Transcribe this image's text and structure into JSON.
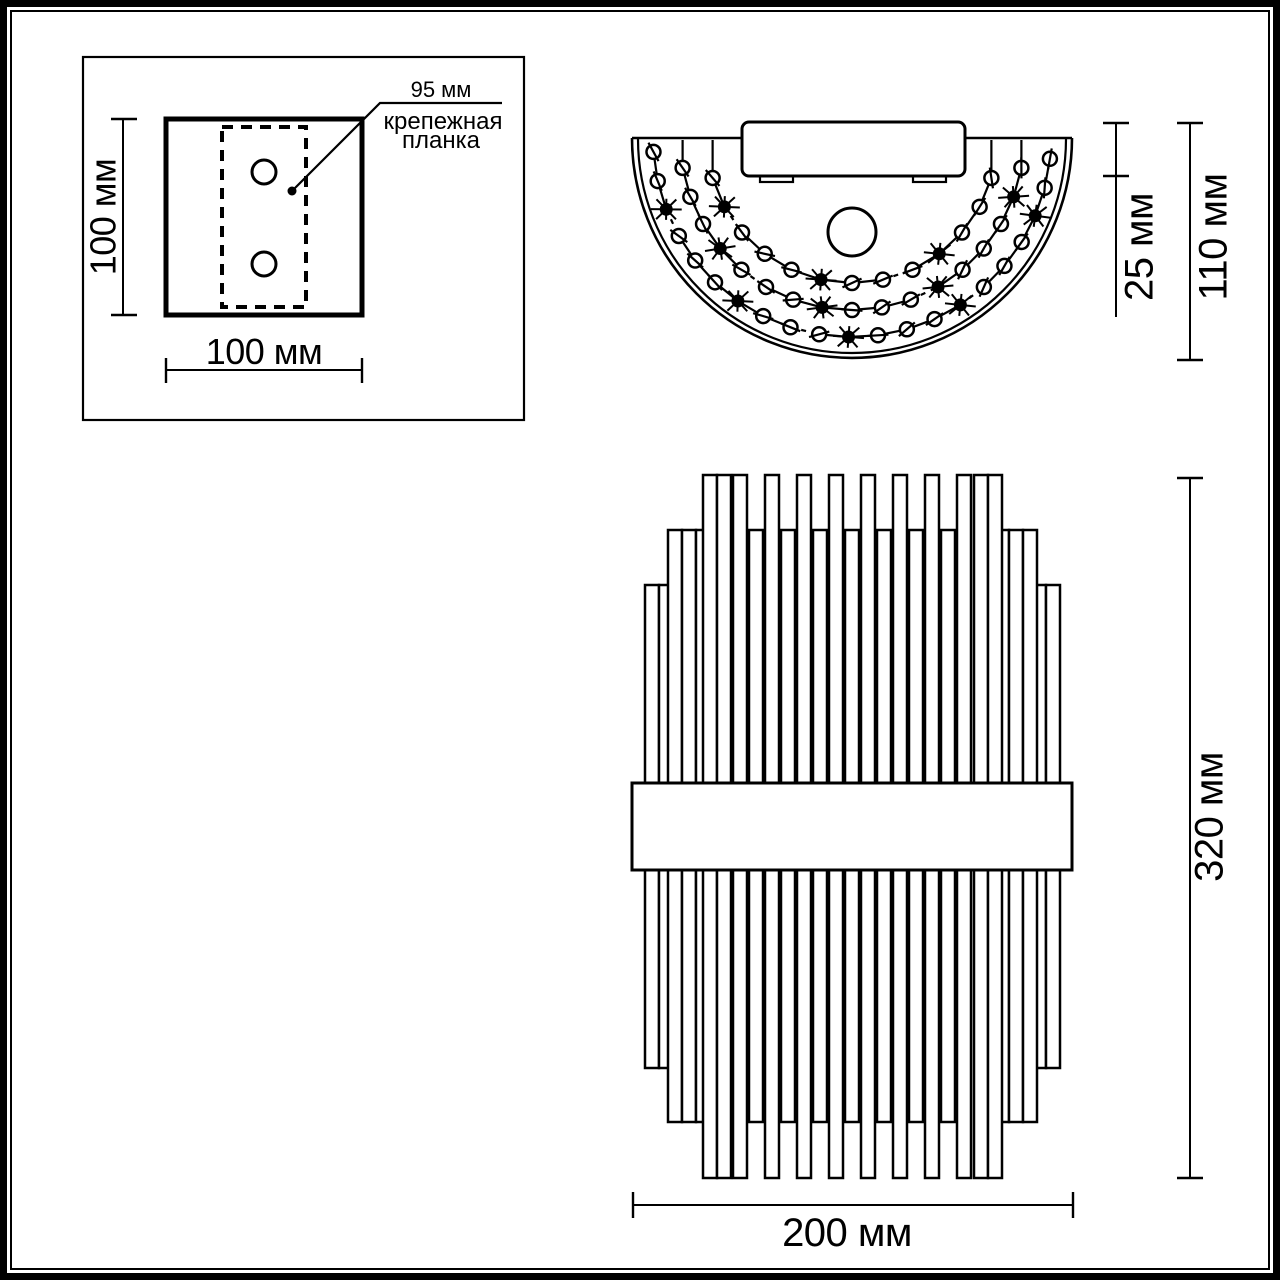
{
  "labels": {
    "plate_height": "100 мм",
    "plate_width": "100 мм",
    "plate_bar_length": "95 мм",
    "plate_note_line1": "крепежная",
    "plate_note_line2": "планка",
    "mount_depth": "25 мм",
    "total_depth": "110 мм",
    "total_height": "320 мм",
    "total_width": "200 мм"
  },
  "colors": {
    "ink": "#000000",
    "paper": "#ffffff"
  },
  "top_view": {
    "center": [
      852,
      138
    ],
    "strands": [
      {
        "r": 199,
        "n": 21,
        "a0": 176,
        "a1": 6,
        "black_every": 4,
        "black_offset": 2,
        "dash_every": 6,
        "dash_offset": 2,
        "connect": false
      },
      {
        "r": 172,
        "n": 17,
        "a0": 170,
        "a1": 10,
        "black_every": 4,
        "black_offset": 1,
        "dash_every": 6,
        "dash_offset": 4,
        "connect": true
      },
      {
        "r": 145,
        "n": 13,
        "a0": 164,
        "a1": 16,
        "black_every": 4,
        "black_offset": 3,
        "dash_every": 6,
        "dash_offset": 1,
        "connect": true
      }
    ]
  },
  "front_view": {
    "rod_width": 14,
    "tiers": {
      "A": {
        "top": 475,
        "bottom": 1178
      },
      "B": {
        "top": 530,
        "bottom": 1122
      },
      "C": {
        "top": 585,
        "bottom": 1068
      }
    },
    "layers": [
      {
        "tier": "C",
        "xs": [
          645,
          659,
          673,
          687,
          1004,
          1018,
          1032,
          1046
        ]
      },
      {
        "tier": "B",
        "xs": [
          668,
          682,
          696,
          710,
          749,
          781,
          813,
          845,
          877,
          909,
          941,
          981,
          995,
          1009,
          1023
        ]
      },
      {
        "tier": "A",
        "xs": [
          703,
          717,
          733,
          765,
          797,
          829,
          861,
          893,
          925,
          957,
          974,
          988
        ]
      }
    ],
    "band": {
      "x": 632,
      "y": 783,
      "w": 440,
      "h": 87
    }
  }
}
